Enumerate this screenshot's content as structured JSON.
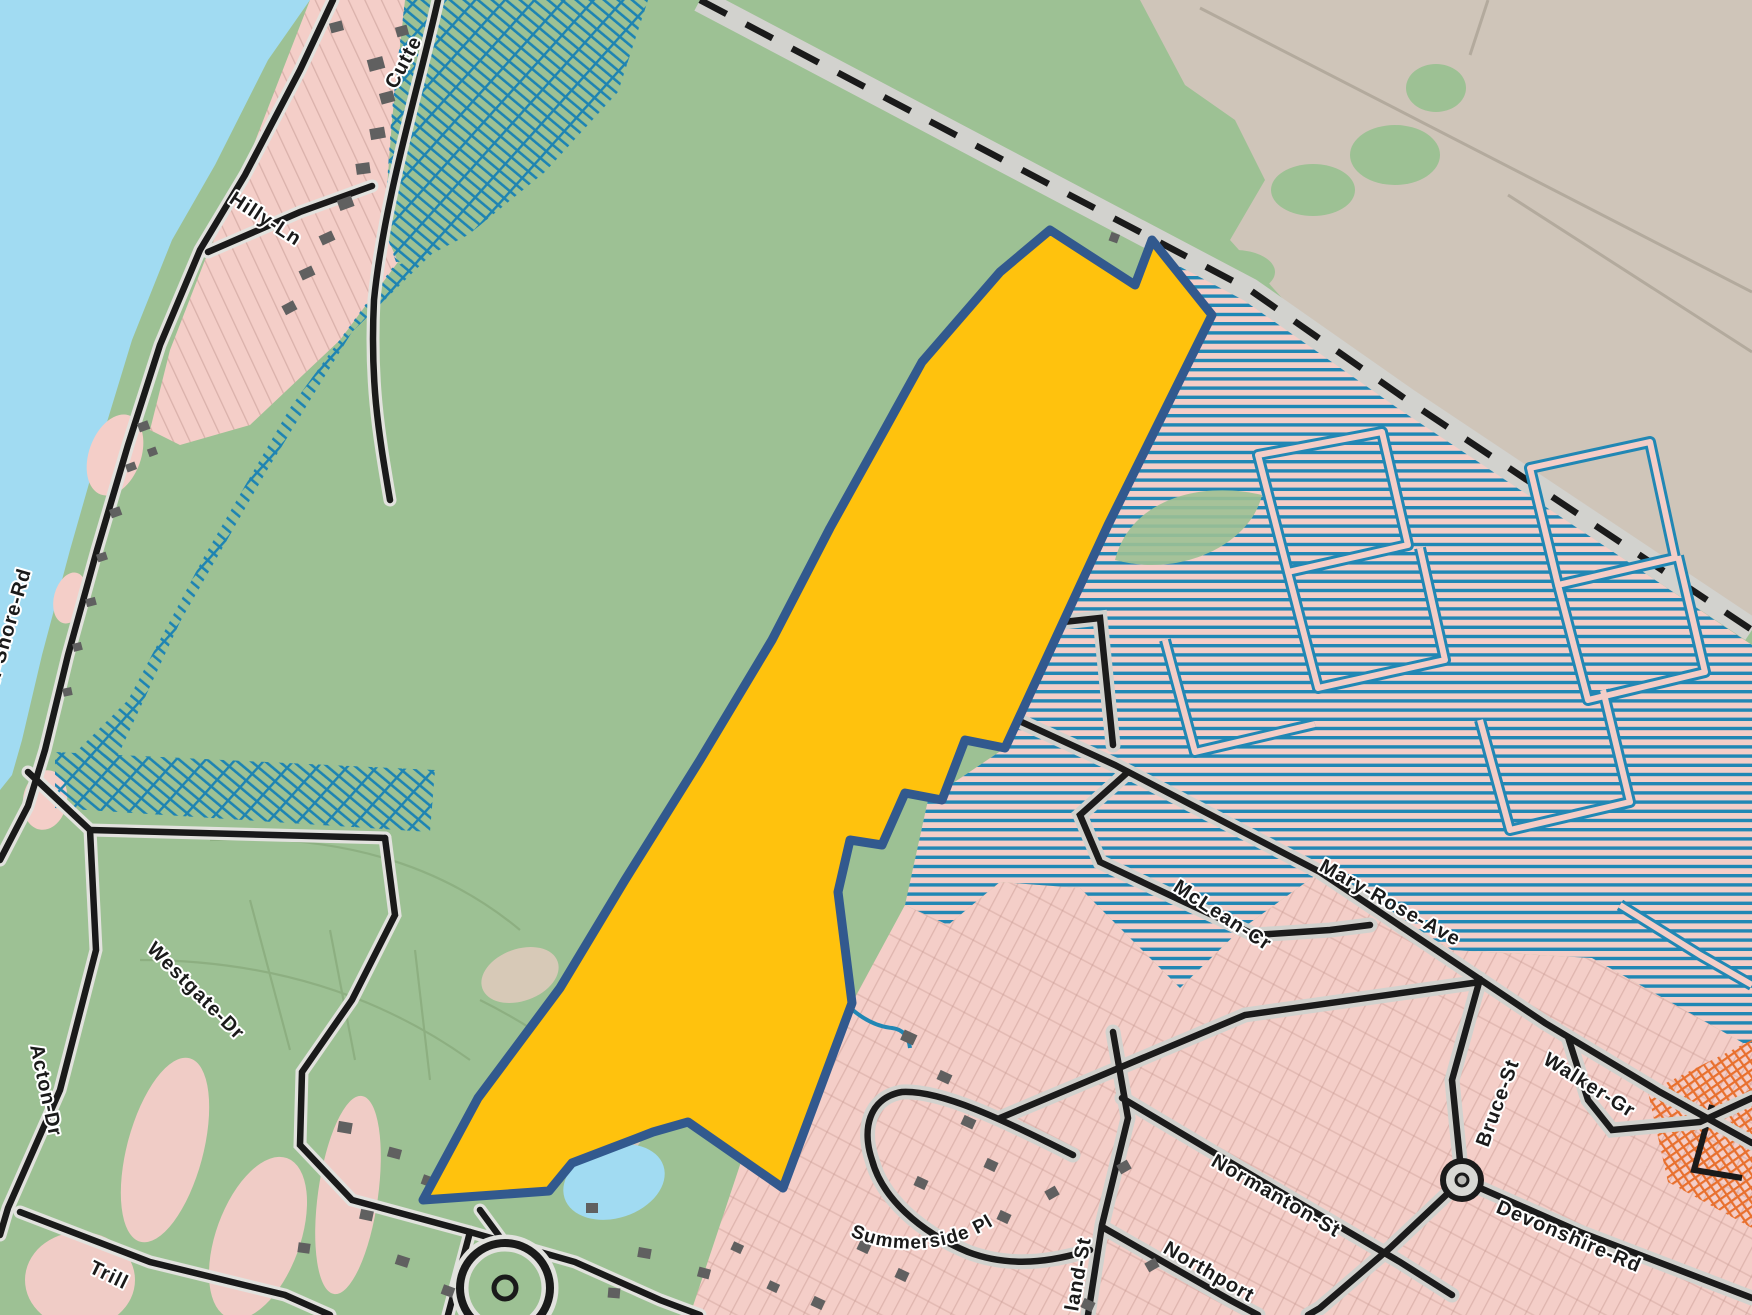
{
  "map": {
    "kind": "municipal zoning / parcel map with highlighted subject parcel",
    "roads": {
      "north_shore_rd": "North-Shore-Rd",
      "hilly_ln": "Hilly-Ln",
      "cutten_partial": "Cutte",
      "acton_dr": "Acton-Dr",
      "westgate_dr": "Westgate-Dr",
      "trillium_partial": "Trill",
      "mary_rose_ave": "Mary-Rose-Ave",
      "mclean_cr": "McLean-Cr",
      "bruce_st": "Bruce-St",
      "walker_gr": "Walker-Gr",
      "devonshire_rd": "Devonshire-Rd",
      "normanton_st": "Normanton-St",
      "northport_partial": "Northport",
      "land_st_partial": "land-St",
      "summerside_pl": "Summerside Pl"
    },
    "colors": {
      "water": "#A1DBF2",
      "open_land_green": "#9DC194",
      "residential_pink": "#F4CEC8",
      "rural_tan": "#CFC5B9",
      "subject_parcel_fill": "#FFC20D",
      "subject_parcel_border": "#32598E",
      "overlay_hatch_blue": "#2187B4",
      "overlay_hatch_orange": "#E8702E",
      "road_black": "#1A1A1A",
      "road_casing": "#D2D2CE",
      "building_gray": "#606060",
      "label_halo": "#FFFFFF"
    }
  }
}
